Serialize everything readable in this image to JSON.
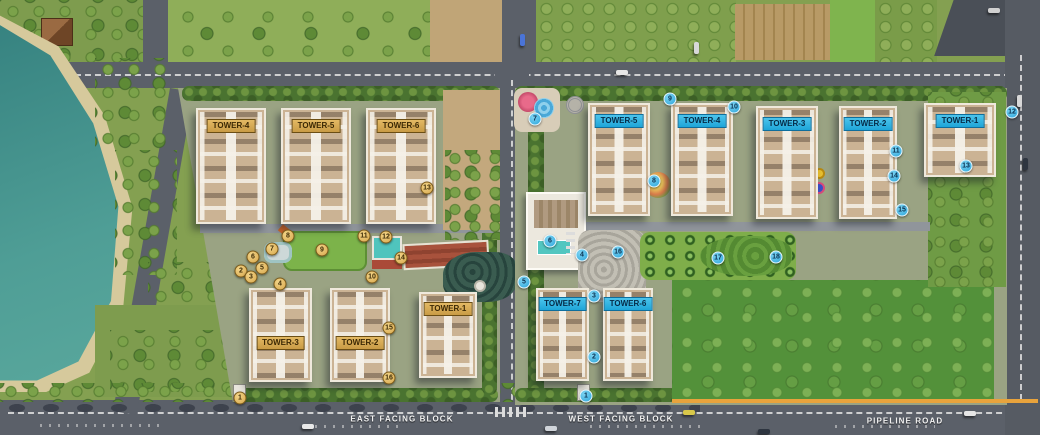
{
  "scene": {
    "width": 1040,
    "height": 435,
    "description": "residential township master plan aerial view"
  },
  "road_labels": [
    {
      "text": "EAST FACING BLOCK",
      "x": 402,
      "y": 419
    },
    {
      "text": "WEST FACING BLOCK",
      "x": 621,
      "y": 419
    },
    {
      "text": "PIPELINE ROAD",
      "x": 905,
      "y": 421
    }
  ],
  "colors": {
    "east_label_bg": "#d3a54f",
    "west_label_bg": "#2db4e2",
    "water": "#4f9e96",
    "boundary_line": "#e8a33c",
    "road": "#5b6069"
  },
  "east_block": {
    "marker_style": "gold",
    "towers": [
      {
        "label": "TOWER-4",
        "x": 196,
        "y": 108,
        "w": 70,
        "h": 116,
        "dy": 9
      },
      {
        "label": "TOWER-5",
        "x": 281,
        "y": 108,
        "w": 70,
        "h": 116,
        "dy": 9
      },
      {
        "label": "TOWER-6",
        "x": 366,
        "y": 108,
        "w": 70,
        "h": 116,
        "dy": 9
      },
      {
        "label": "TOWER-3",
        "x": 249,
        "y": 288,
        "w": 63,
        "h": 94,
        "dy": 46
      },
      {
        "label": "TOWER-2",
        "x": 330,
        "y": 288,
        "w": 60,
        "h": 94,
        "dy": 46
      },
      {
        "label": "TOWER-1",
        "x": 419,
        "y": 292,
        "w": 58,
        "h": 86,
        "dy": 8
      }
    ],
    "markers": [
      {
        "n": "1",
        "x": 240,
        "y": 398
      },
      {
        "n": "2",
        "x": 241,
        "y": 271
      },
      {
        "n": "3",
        "x": 251,
        "y": 277
      },
      {
        "n": "4",
        "x": 280,
        "y": 284
      },
      {
        "n": "5",
        "x": 262,
        "y": 268
      },
      {
        "n": "6",
        "x": 253,
        "y": 257
      },
      {
        "n": "7",
        "x": 272,
        "y": 249
      },
      {
        "n": "8",
        "x": 288,
        "y": 236
      },
      {
        "n": "9",
        "x": 322,
        "y": 250
      },
      {
        "n": "10",
        "x": 372,
        "y": 277
      },
      {
        "n": "11",
        "x": 364,
        "y": 236
      },
      {
        "n": "12",
        "x": 386,
        "y": 237
      },
      {
        "n": "13",
        "x": 427,
        "y": 188
      },
      {
        "n": "14",
        "x": 401,
        "y": 258
      },
      {
        "n": "15",
        "x": 389,
        "y": 328
      },
      {
        "n": "16",
        "x": 389,
        "y": 378
      }
    ]
  },
  "west_block": {
    "marker_style": "blue",
    "towers": [
      {
        "label": "TOWER-5",
        "x": 588,
        "y": 103,
        "w": 62,
        "h": 113,
        "dy": 9
      },
      {
        "label": "TOWER-4",
        "x": 671,
        "y": 103,
        "w": 62,
        "h": 113,
        "dy": 9
      },
      {
        "label": "TOWER-3",
        "x": 756,
        "y": 106,
        "w": 62,
        "h": 113,
        "dy": 9
      },
      {
        "label": "TOWER-2",
        "x": 839,
        "y": 106,
        "w": 58,
        "h": 113,
        "dy": 9
      },
      {
        "label": "TOWER-1",
        "x": 924,
        "y": 103,
        "w": 72,
        "h": 74,
        "dy": 9
      },
      {
        "label": "TOWER-7",
        "x": 536,
        "y": 288,
        "w": 53,
        "h": 93,
        "dy": 7
      },
      {
        "label": "TOWER-6",
        "x": 603,
        "y": 288,
        "w": 50,
        "h": 93,
        "dy": 7
      }
    ],
    "markers": [
      {
        "n": "1",
        "x": 586,
        "y": 396
      },
      {
        "n": "2",
        "x": 594,
        "y": 357
      },
      {
        "n": "3",
        "x": 594,
        "y": 296
      },
      {
        "n": "4",
        "x": 582,
        "y": 255
      },
      {
        "n": "5",
        "x": 524,
        "y": 282
      },
      {
        "n": "6",
        "x": 550,
        "y": 241
      },
      {
        "n": "7",
        "x": 535,
        "y": 119
      },
      {
        "n": "8",
        "x": 654,
        "y": 181
      },
      {
        "n": "9",
        "x": 670,
        "y": 99
      },
      {
        "n": "10",
        "x": 734,
        "y": 107
      },
      {
        "n": "11",
        "x": 896,
        "y": 151
      },
      {
        "n": "12",
        "x": 1012,
        "y": 112
      },
      {
        "n": "13",
        "x": 966,
        "y": 166
      },
      {
        "n": "14",
        "x": 894,
        "y": 176
      },
      {
        "n": "15",
        "x": 902,
        "y": 210
      },
      {
        "n": "16",
        "x": 618,
        "y": 252
      },
      {
        "n": "17",
        "x": 718,
        "y": 258
      },
      {
        "n": "18",
        "x": 776,
        "y": 257
      }
    ]
  },
  "vehicles": [
    {
      "x": 616,
      "y": 70,
      "c": "#e6e6e6",
      "o": "h"
    },
    {
      "x": 520,
      "y": 34,
      "c": "#4a74d8",
      "o": "v"
    },
    {
      "x": 694,
      "y": 42,
      "c": "#d8d8d8",
      "o": "v"
    },
    {
      "x": 302,
      "y": 424,
      "c": "#e8e8e8",
      "o": "h"
    },
    {
      "x": 545,
      "y": 426,
      "c": "#d0d4da",
      "o": "h"
    },
    {
      "x": 683,
      "y": 410,
      "c": "#d8c84a",
      "o": "h"
    },
    {
      "x": 758,
      "y": 429,
      "c": "#2e3540",
      "o": "h"
    },
    {
      "x": 964,
      "y": 411,
      "c": "#e6e6e6",
      "o": "h"
    },
    {
      "x": 1017,
      "y": 95,
      "c": "#d8d8d8",
      "o": "v"
    },
    {
      "x": 1023,
      "y": 158,
      "c": "#2e3540",
      "o": "v"
    },
    {
      "x": 988,
      "y": 8,
      "c": "#d0d0d0",
      "o": "h"
    }
  ]
}
